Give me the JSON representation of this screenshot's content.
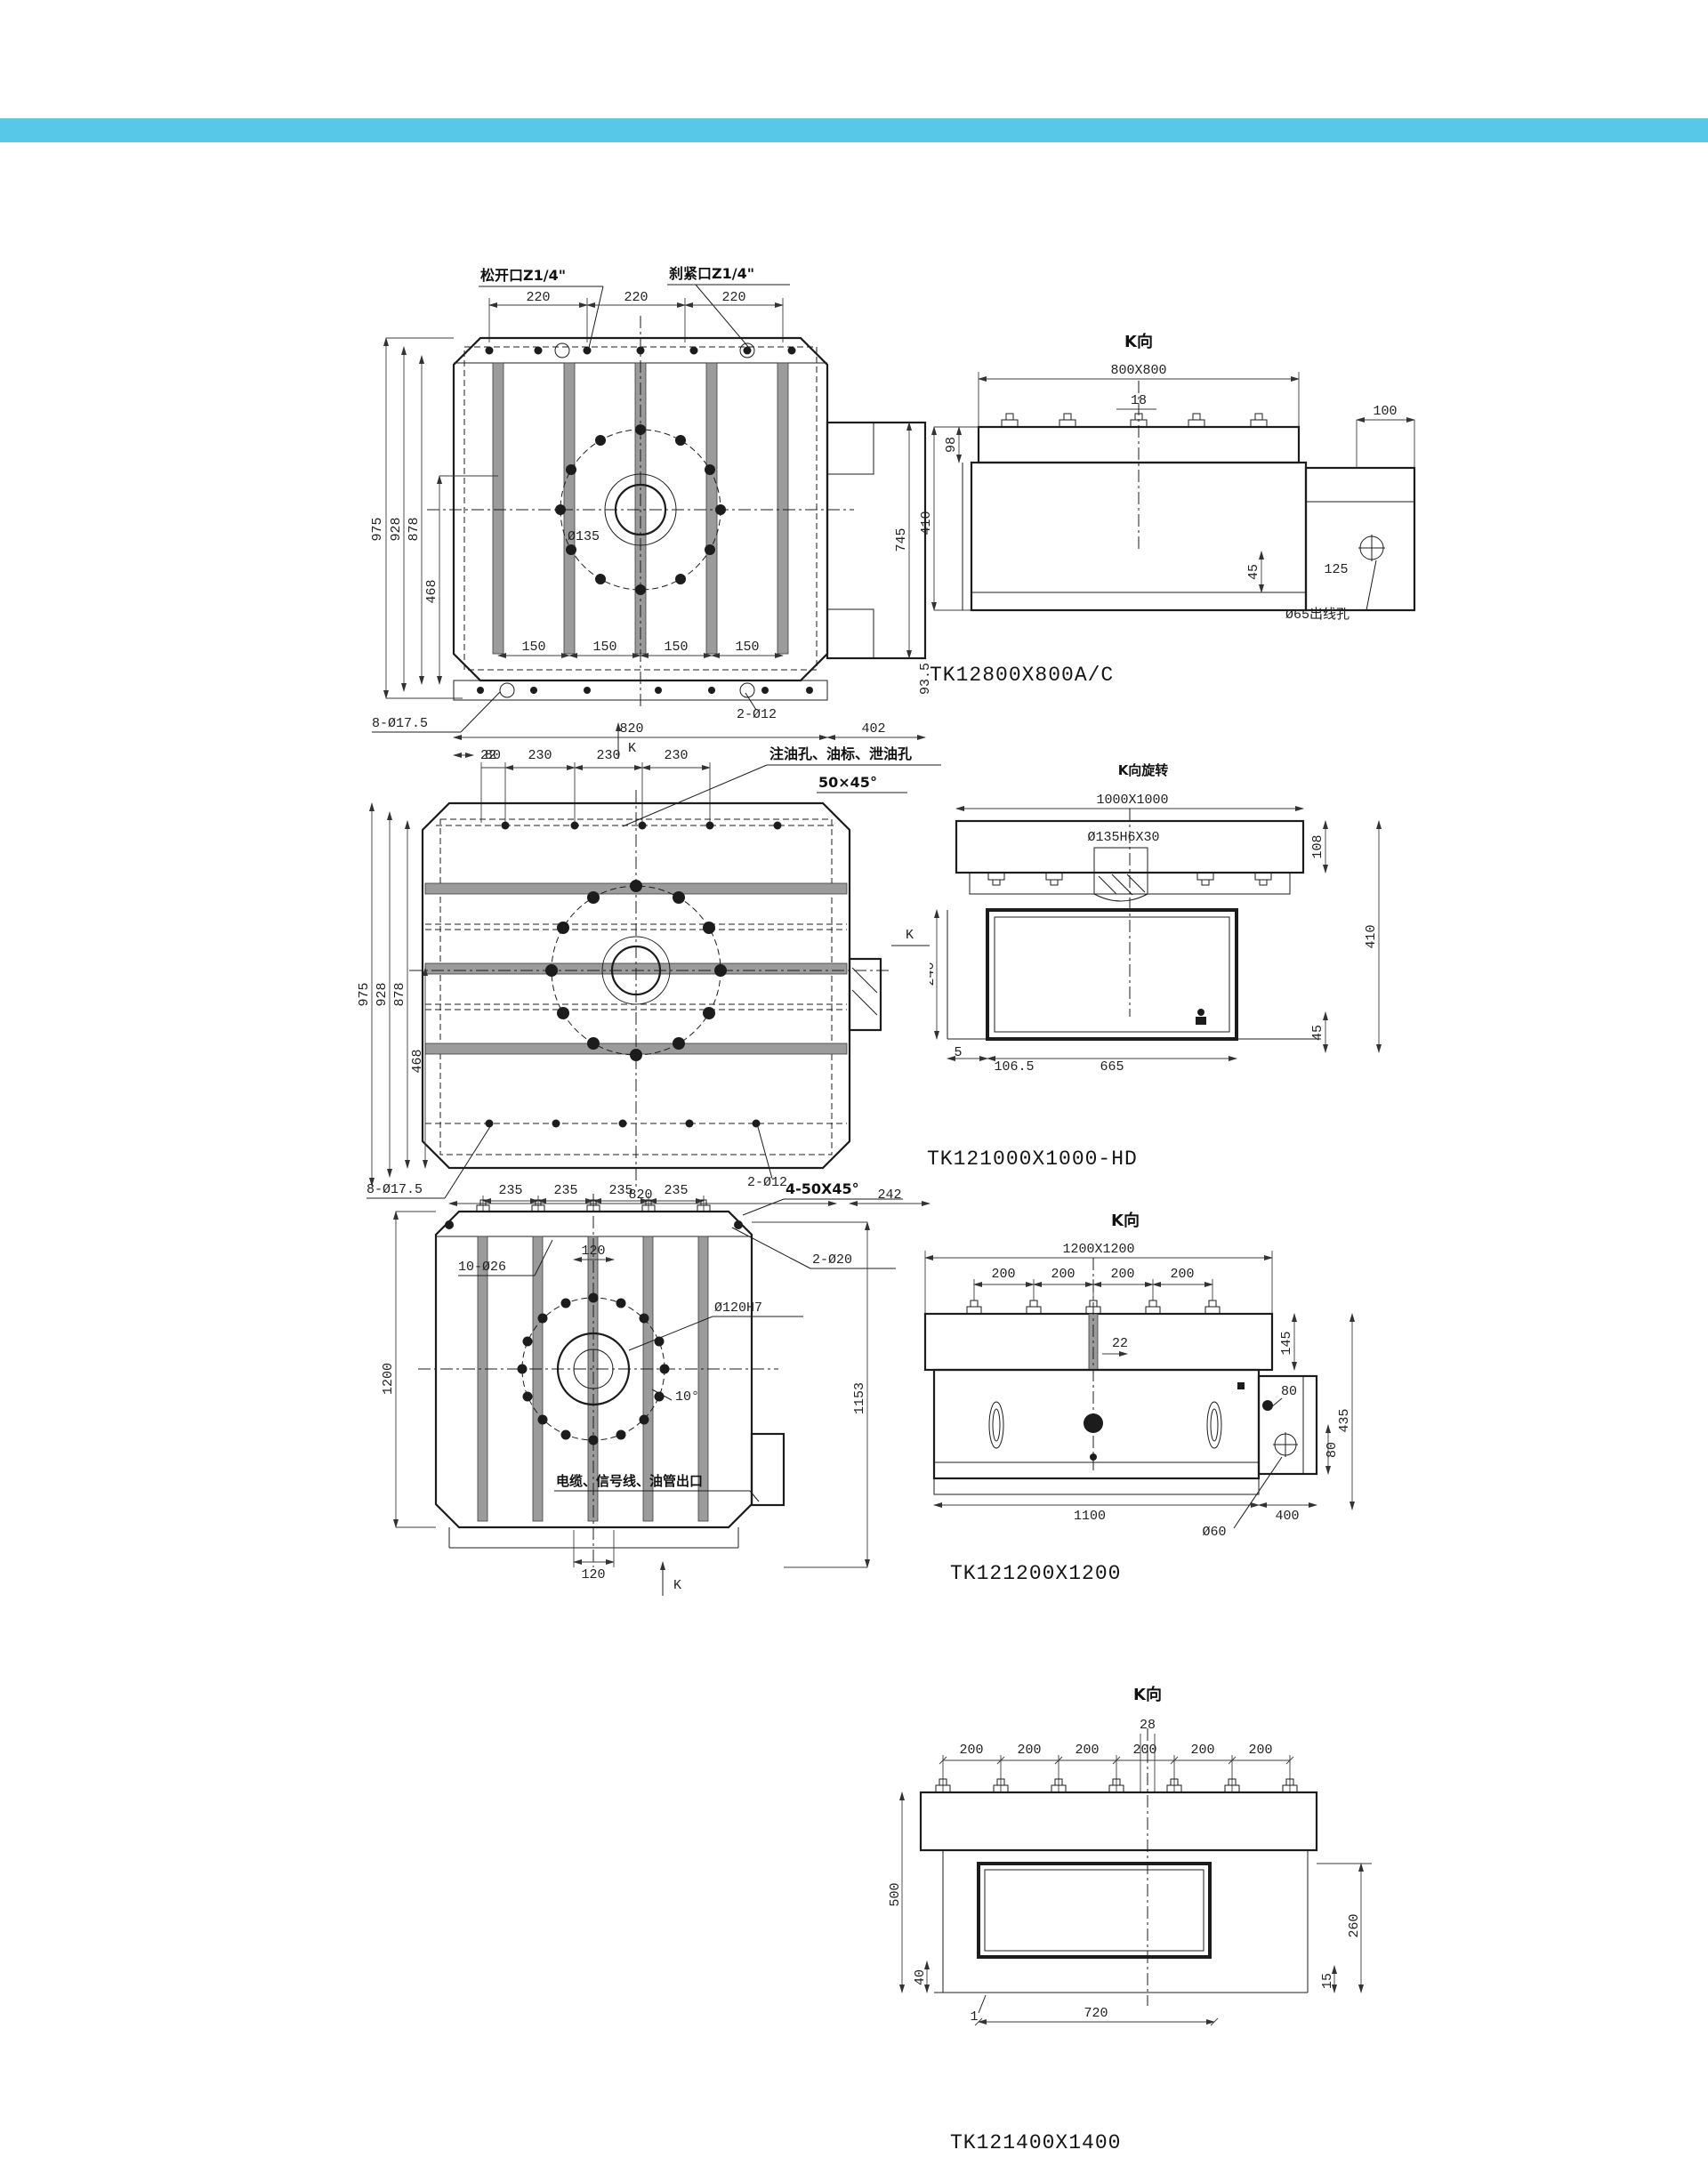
{
  "page": {
    "accent_color": "#58c8e9"
  },
  "drawings": [
    {
      "title": "TK12800X800A/C",
      "front": {
        "loosen_label": "松开口Z1/4\"",
        "clamp_label": "刹紧口Z1/4\"",
        "top_dims": [
          "220",
          "220",
          "220"
        ],
        "left_dims": [
          "975",
          "928",
          "878",
          "468"
        ],
        "slot_dims": [
          "150",
          "150",
          "150",
          "150"
        ],
        "bore_label": "Ø135",
        "holes_label": "8-Ø17.5",
        "edge_dim": "22",
        "bottom_dims": [
          "820",
          "2-Ø12",
          "402"
        ],
        "right_dims": [
          "745",
          "93.5"
        ],
        "k_label": "K"
      },
      "side": {
        "view_label": "K向",
        "size_label": "800X800",
        "slot_dim": "18",
        "plate_dim": "98",
        "height_dim": "410",
        "inner_dim": "45",
        "box_top_dim": "100",
        "box_dim": "125",
        "outlet_label": "Ø65出线孔"
      }
    },
    {
      "title": "TK121000X1000-HD",
      "front": {
        "top_dims": [
          "80",
          "230",
          "230",
          "230"
        ],
        "oil_label": "注油孔、油标、泄油孔",
        "chamfer_label": "50×45°",
        "left_dims": [
          "975",
          "928",
          "878",
          "468"
        ],
        "holes_label": "8-Ø17.5",
        "bottom_dims": [
          "820",
          "2-Ø12",
          "242"
        ],
        "k_label": "K"
      },
      "side": {
        "view_label": "K向旋转",
        "size_label": "1000X1000",
        "bore_label": "Ø135H6X30",
        "plate_dim": "108",
        "height_dim": "410",
        "inner_dim": "45",
        "left_dims": [
          "240",
          "5"
        ],
        "bottom_dims": [
          "106.5",
          "665"
        ]
      }
    },
    {
      "title": "TK121200X1200",
      "front": {
        "top_dims": [
          "235",
          "235",
          "235",
          "235"
        ],
        "chamfer_label": "4-50X45°",
        "holes_label": "10-Ø26",
        "slot_dim": "120",
        "pin_label": "2-Ø20",
        "bore_label": "Ø120H7",
        "angle_label": "10°",
        "left_dim": "1200",
        "right_dim": "1153",
        "bottom_dim": "120",
        "outlet_label": "电缆、信号线、油管出口",
        "k_label": "K"
      },
      "side": {
        "view_label": "K向",
        "size_label": "1200X1200",
        "top_dims": [
          "200",
          "200",
          "200",
          "200"
        ],
        "slot_dim": "22",
        "plate_dim": "145",
        "height_dim": "435",
        "box_dims": [
          "80",
          "80"
        ],
        "bottom_dims": [
          "1100",
          "400"
        ],
        "hole_label": "Ø60"
      }
    },
    {
      "title": "TK121400X1400",
      "front": {
        "top_dims": [
          "1050",
          "1000",
          "540",
          "515"
        ],
        "holes_label": "10-Ø26",
        "left_dims": [
          "1400",
          "920",
          "610"
        ],
        "right_dims": [
          "210",
          "210",
          "210",
          "210"
        ],
        "chamfer_label": "4-250 x 45°",
        "bore_label": "Ø150",
        "bottom_dim": "1400",
        "k_label": "K"
      },
      "side": {
        "view_label": "K向",
        "center_dim": "28",
        "top_dims": [
          "200",
          "200",
          "200",
          "200",
          "200",
          "200"
        ],
        "left_dims": [
          "500",
          "40"
        ],
        "right_dims": [
          "260",
          "15"
        ],
        "bottom_dims": [
          "1",
          "720"
        ]
      }
    }
  ]
}
